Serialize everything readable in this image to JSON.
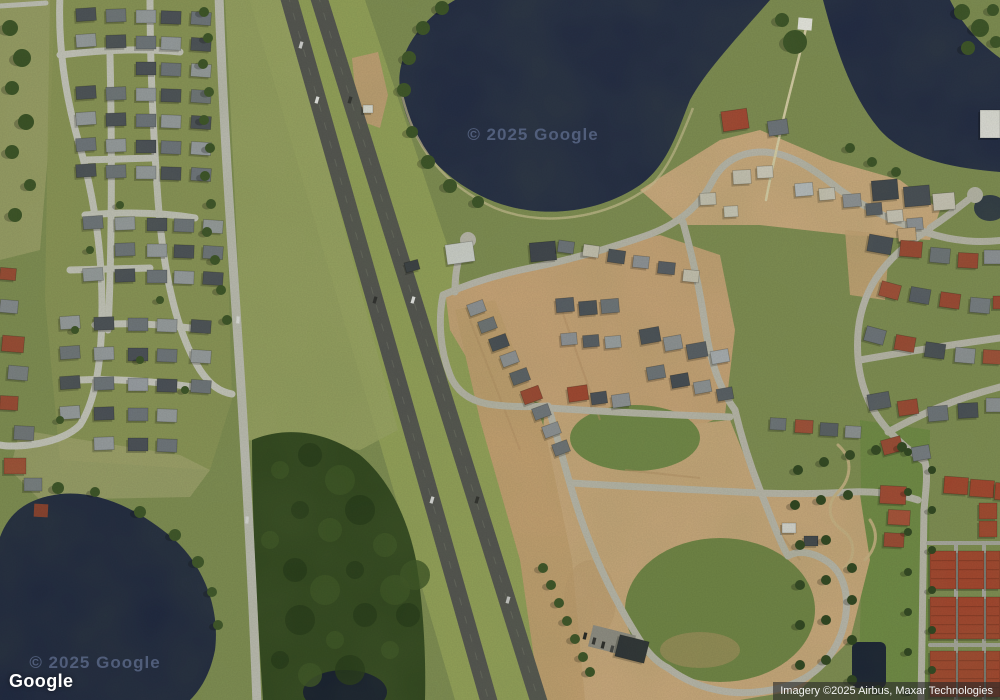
{
  "map": {
    "google_logo": "Google",
    "attribution": "Imagery ©2025 Airbus, Maxar Technologies",
    "watermark_center": "© 2025 Google",
    "watermark_lake": "© 2025 Google"
  },
  "colors": {
    "water": "#222b44",
    "grass": "#7e8d52",
    "forest": "#31471f",
    "dirt": "#c7a377",
    "road_light": "#c4c4bc",
    "highway": "#525350",
    "roof_red": "#a3452e",
    "roof_dark": "#474c55",
    "attribution_bg": "rgba(40,40,40,0.62)"
  }
}
